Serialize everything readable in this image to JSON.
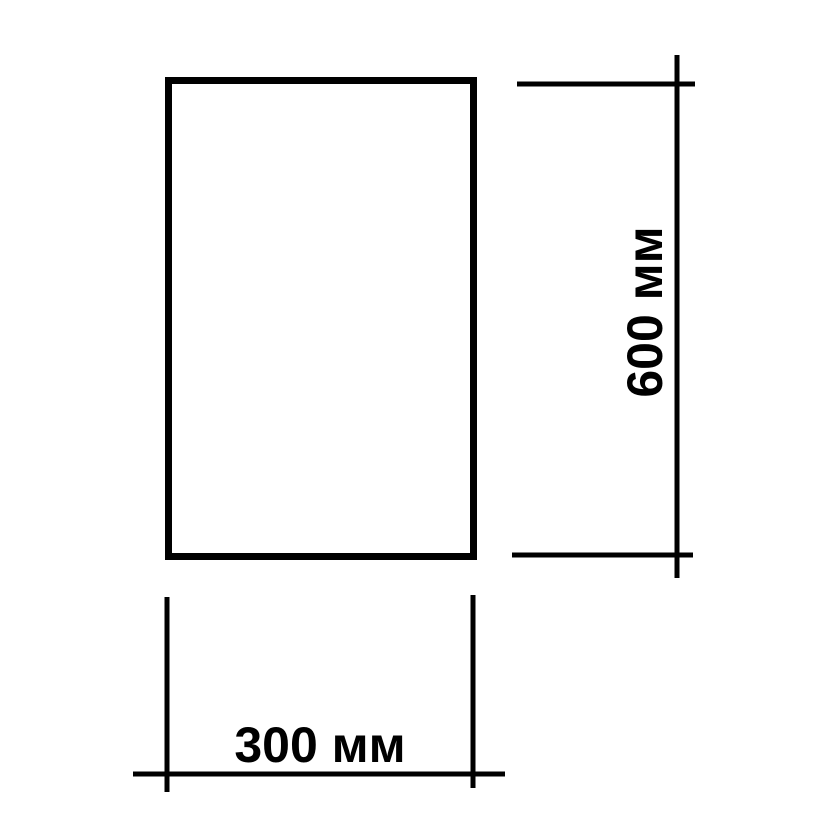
{
  "diagram": {
    "shape": "rectangle",
    "background_color": "#ffffff",
    "line_color": "#000000",
    "height_label": "600 мм",
    "width_label": "300 мм"
  }
}
